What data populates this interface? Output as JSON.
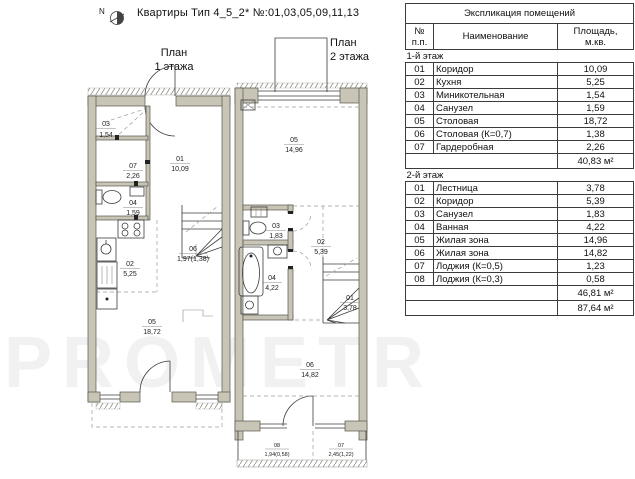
{
  "header": {
    "north": "N",
    "title": "Квартиры Тип 4_5_2* №:01,03,05,09,11,13"
  },
  "watermark": "PROMETR",
  "plan1": {
    "label": "План\n1 этажа",
    "rooms": {
      "r01": {
        "num": "01",
        "area": "10,09"
      },
      "r02": {
        "num": "02",
        "area": "5,25"
      },
      "r03": {
        "num": "03",
        "area": "1,54"
      },
      "r04": {
        "num": "04",
        "area": "1,59"
      },
      "r05": {
        "num": "05",
        "area": "18,72"
      },
      "r06": {
        "num": "06",
        "area": "1,97(1,38)"
      },
      "r07": {
        "num": "07",
        "area": "2,26"
      }
    }
  },
  "plan2": {
    "label": "План\n2 этажа",
    "rooms": {
      "r01": {
        "num": "01",
        "area": "3,78"
      },
      "r02": {
        "num": "02",
        "area": "5,39"
      },
      "r03": {
        "num": "03",
        "area": "1,83"
      },
      "r04": {
        "num": "04",
        "area": "4,22"
      },
      "r05": {
        "num": "05",
        "area": "14,96"
      },
      "r06": {
        "num": "06",
        "area": "14,82"
      },
      "l07": {
        "num": "07",
        "area": "2,45(1,22)"
      },
      "l08": {
        "num": "08",
        "area": "1,94(0,58)"
      }
    }
  },
  "table": {
    "title": "Экспликация помещений",
    "col_num": "№\nп.п.",
    "col_name": "Наименование",
    "col_area": "Площадь,\nм.кв.",
    "floor1": {
      "label": "1-й этаж",
      "rows": [
        {
          "n": "01",
          "name": "Коридор",
          "a": "10,09"
        },
        {
          "n": "02",
          "name": "Кухня",
          "a": "5,25"
        },
        {
          "n": "03",
          "name": "Миникотельная",
          "a": "1,54"
        },
        {
          "n": "04",
          "name": "Санузел",
          "a": "1,59"
        },
        {
          "n": "05",
          "name": "Столовая",
          "a": "18,72"
        },
        {
          "n": "06",
          "name": "Столовая (К=0,7)",
          "a": "1,38"
        },
        {
          "n": "07",
          "name": "Гардеробная",
          "a": "2,26"
        }
      ],
      "subtotal": "40,83 м²"
    },
    "floor2": {
      "label": "2-й этаж",
      "rows": [
        {
          "n": "01",
          "name": "Лестница",
          "a": "3,78"
        },
        {
          "n": "02",
          "name": "Коридор",
          "a": "5,39"
        },
        {
          "n": "03",
          "name": "Санузел",
          "a": "1,83"
        },
        {
          "n": "04",
          "name": "Ванная",
          "a": "4,22"
        },
        {
          "n": "05",
          "name": "Жилая зона",
          "a": "14,96"
        },
        {
          "n": "06",
          "name": "Жилая зона",
          "a": "14,82"
        },
        {
          "n": "07",
          "name": "Лоджия (К=0,5)",
          "a": "1,23"
        },
        {
          "n": "08",
          "name": "Лоджия (К=0,3)",
          "a": "0,58"
        }
      ],
      "subtotal": "46,81 м²"
    },
    "total": "87,64 м²"
  }
}
